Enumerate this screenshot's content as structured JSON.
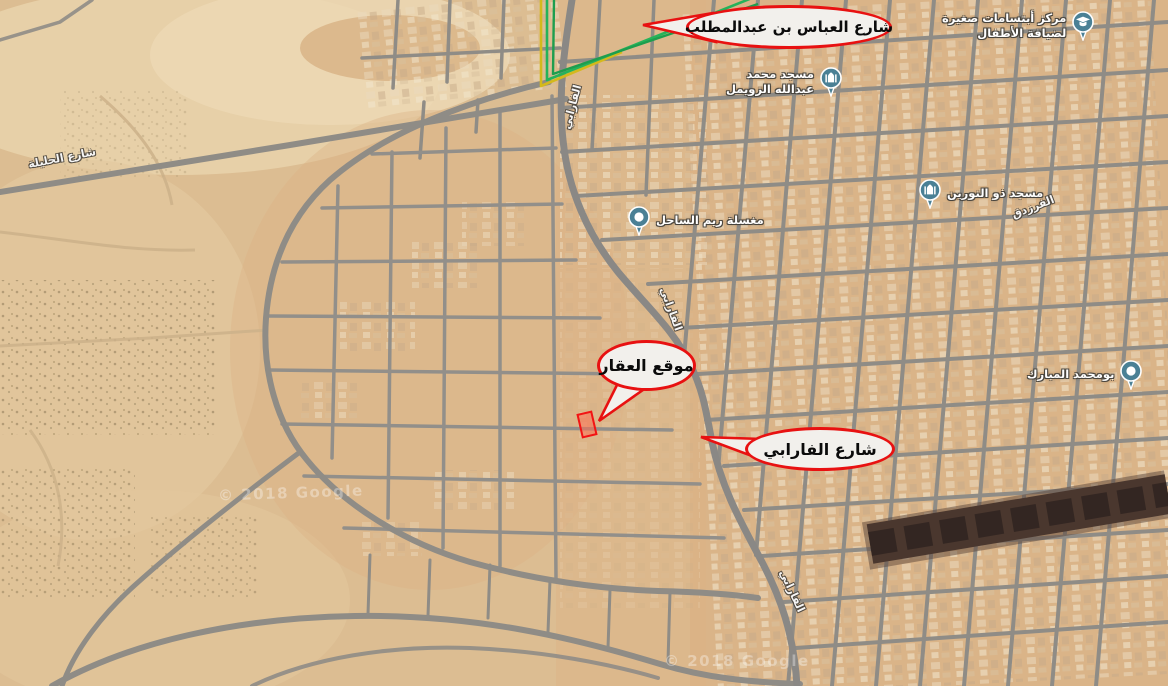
{
  "annotations": {
    "callouts": [
      {
        "id": "street-abbas",
        "label": "شارع العباس بن عبدالمطلب"
      },
      {
        "id": "property-location",
        "label": "موقع العقار"
      },
      {
        "id": "street-farabi",
        "label": "شارع الفارابي"
      }
    ],
    "property_marker": "red-rectangle"
  },
  "pois": [
    {
      "id": "mosque-zuwaimel",
      "icon": "mosque-icon",
      "lines": [
        "مسجد محمد",
        "عبدالله الزويمل"
      ]
    },
    {
      "id": "smiles-center",
      "icon": "education-icon",
      "lines": [
        "مركز أبتسامات صغيرة",
        "لضيافة الأطفال"
      ]
    },
    {
      "id": "mosque-nurain",
      "icon": "mosque-icon",
      "lines": [
        "مسجد ذو النورين"
      ]
    },
    {
      "id": "laundry-reem",
      "icon": "place-icon",
      "lines": [
        "مغسلة ريم الساحل"
      ]
    },
    {
      "id": "bumohammed",
      "icon": "place-icon",
      "lines": [
        "بومحمد المبارك"
      ]
    }
  ],
  "street_labels": [
    {
      "id": "farabi-top",
      "label": "الفارابي"
    },
    {
      "id": "farabi-mid",
      "label": "الفارابي"
    },
    {
      "id": "farabi-bottom",
      "label": "الفارابي"
    },
    {
      "id": "halila",
      "label": "شارع الحليلة"
    },
    {
      "id": "farazdaq",
      "label": "الفرزدق"
    }
  ],
  "watermarks": [
    "© 2018 Google",
    "© 2018 Google"
  ],
  "colors": {
    "annotation_red": "#e81111",
    "pin_teal": "#4a8095",
    "highlight_green": "#25b35a",
    "highlight_yellow": "#d4b91c",
    "road_gray": "#8f8c86",
    "sand": "#dcbd92"
  }
}
